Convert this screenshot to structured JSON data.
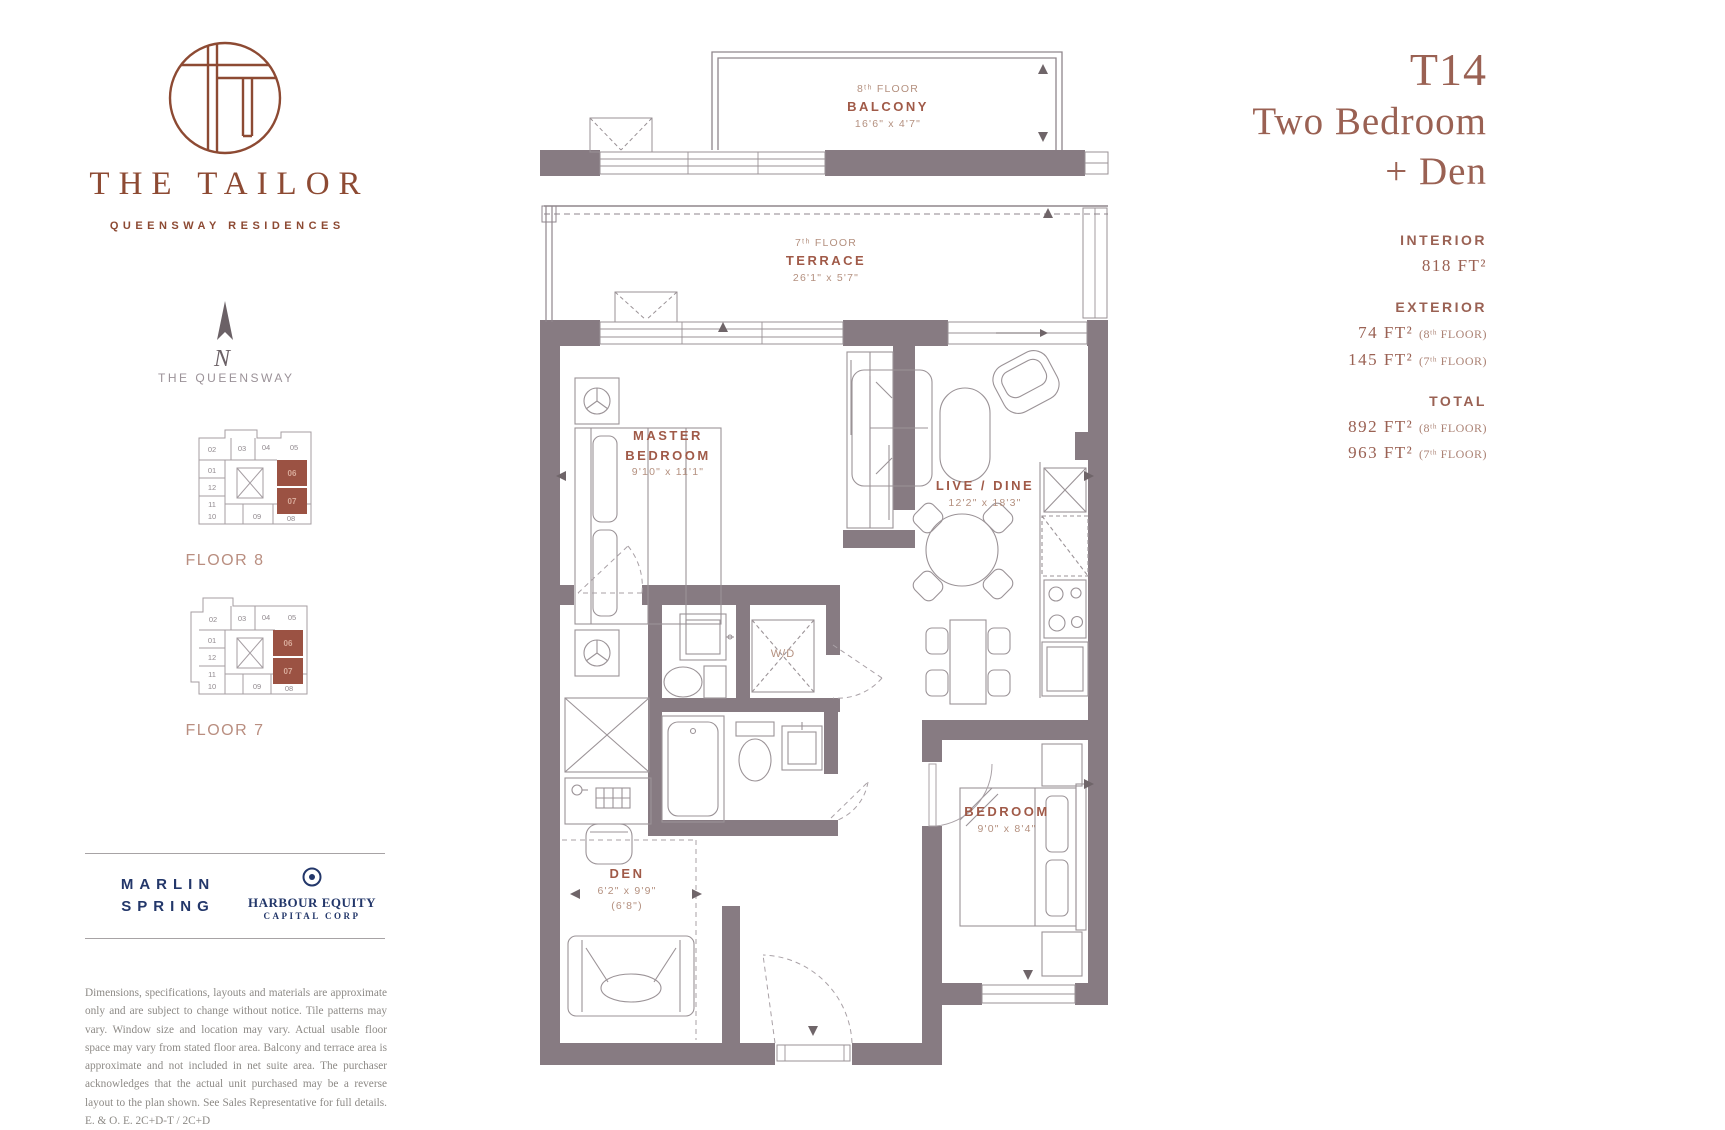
{
  "brand": {
    "name": "THE TAILOR",
    "tagline": "QUEENSWAY RESIDENCES"
  },
  "compass": {
    "n": "N",
    "street": "THE QUEENSWAY"
  },
  "keyplans": {
    "floor8": {
      "label": "FLOOR 8",
      "units": [
        "02",
        "03",
        "04",
        "05",
        "01",
        "12",
        "11",
        "10",
        "09",
        "08"
      ],
      "unit06": "06",
      "unit07": "07"
    },
    "floor7": {
      "label": "FLOOR 7",
      "units": [
        "02",
        "03",
        "04",
        "05",
        "01",
        "12",
        "11",
        "10",
        "09",
        "08"
      ],
      "unit06": "06",
      "unit07": "07"
    }
  },
  "developers": {
    "marlin1": "MARLIN",
    "marlin2": "SPRING",
    "harbour1": "HARBOUR EQUITY",
    "harbour2": "CAPITAL CORP"
  },
  "disclaimer": "Dimensions, specifications, layouts and materials are approximate only and are subject to change without notice. Tile patterns may vary. Window size and location may vary. Actual usable floor space may vary from stated floor area. Balcony and terrace area is approximate and not included in net suite area. The purchaser acknowledges that the actual unit purchased may be a reverse layout to the plan shown. See Sales Representative for full details. E. & O. E. 2C+D-T / 2C+D",
  "header": {
    "code": "T14",
    "line1": "Two Bedroom",
    "line2": "+ Den"
  },
  "stats": {
    "interior_label": "INTERIOR",
    "interior_value": "818 FT²",
    "exterior_label": "EXTERIOR",
    "ext1_value": "74 FT²",
    "ext1_note": "(8ᵗʰ FLOOR)",
    "ext2_value": "145 FT²",
    "ext2_note": "(7ᵗʰ FLOOR)",
    "total_label": "TOTAL",
    "tot1_value": "892 FT²",
    "tot1_note": "(8ᵗʰ FLOOR)",
    "tot2_value": "963 FT²",
    "tot2_note": "(7ᵗʰ FLOOR)"
  },
  "plan": {
    "balcony": {
      "floor": "8ᵗʰ FLOOR",
      "name": "BALCONY",
      "dims": "16'6\" x 4'7\""
    },
    "terrace": {
      "floor": "7ᵗʰ FLOOR",
      "name": "TERRACE",
      "dims": "26'1\" x 5'7\""
    },
    "master": {
      "name": "MASTER BEDROOM",
      "dims": "9'10\" x 11'1\""
    },
    "livedine": {
      "name": "LIVE / DINE",
      "dims": "12'2\" x 18'3\""
    },
    "bedroom": {
      "name": "BEDROOM",
      "dims": "9'0\" x 8'4\""
    },
    "den": {
      "name": "DEN",
      "dims": "6'2\" x 9'9\"",
      "dims2": "(6'8\")"
    },
    "wd": "W/D"
  },
  "colors": {
    "accent_rust": "#8d4a33",
    "accent_rose": "#a05a48",
    "wall": "#877b82",
    "navy": "#23376a",
    "keyplan_highlight": "#9b5243"
  }
}
